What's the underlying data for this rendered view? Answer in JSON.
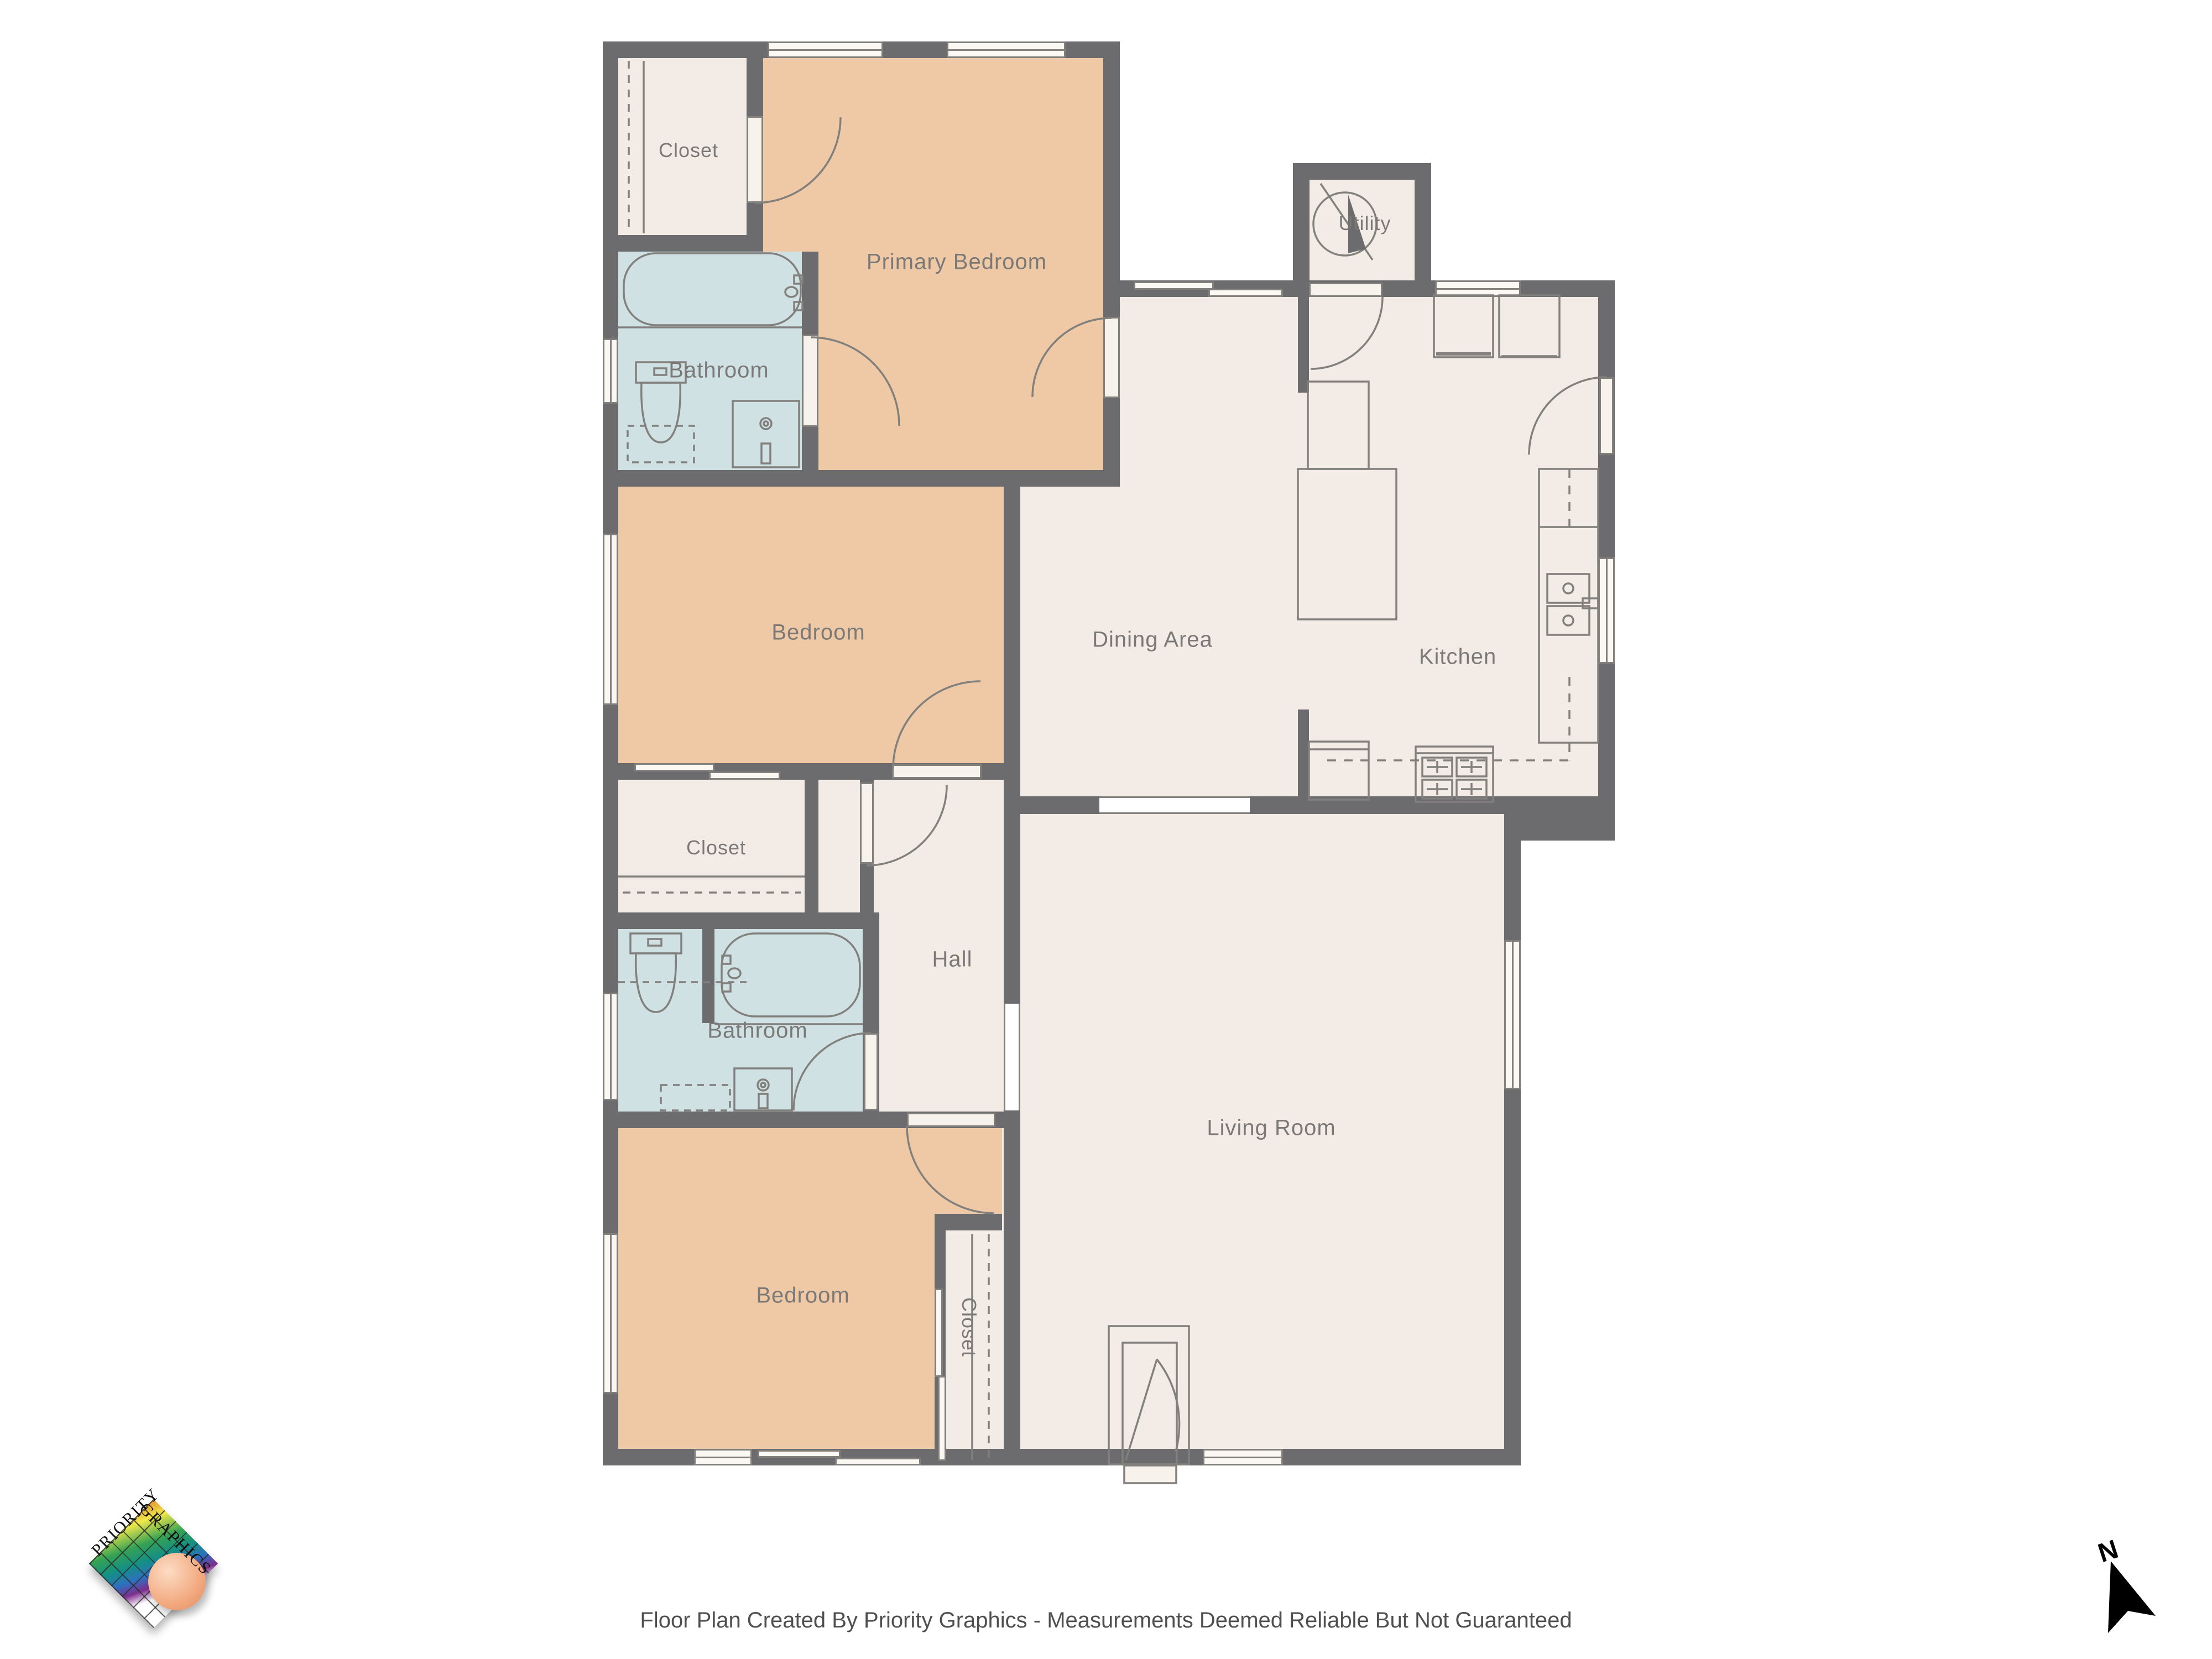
{
  "footer": {
    "text": "Floor Plan Created By Priority Graphics - Measurements Deemed Reliable But Not Guaranteed"
  },
  "logo": {
    "word1": "Priority",
    "word2": "Graphics"
  },
  "compass": {
    "label": "N"
  },
  "rooms": [
    {
      "id": "closet-top",
      "label": "Closet"
    },
    {
      "id": "primary-bedroom",
      "label": "Primary Bedroom"
    },
    {
      "id": "bathroom-top",
      "label": "Bathroom"
    },
    {
      "id": "bedroom-middle",
      "label": "Bedroom"
    },
    {
      "id": "dining-area",
      "label": "Dining Area"
    },
    {
      "id": "kitchen",
      "label": "Kitchen"
    },
    {
      "id": "utility",
      "label": "Utility"
    },
    {
      "id": "closet-middle",
      "label": "Closet"
    },
    {
      "id": "hall",
      "label": "Hall"
    },
    {
      "id": "bathroom-middle",
      "label": "Bathroom"
    },
    {
      "id": "living-room",
      "label": "Living Room"
    },
    {
      "id": "bedroom-bottom",
      "label": "Bedroom"
    },
    {
      "id": "closet-bottom",
      "label": "Closet"
    }
  ],
  "colors": {
    "wall": "#6c6c6e",
    "floor": "#f3ece6",
    "bedroom": "#efc9a5",
    "bathroom": "#cfe1e2",
    "line": "#82807d",
    "label": "#7b7977"
  }
}
